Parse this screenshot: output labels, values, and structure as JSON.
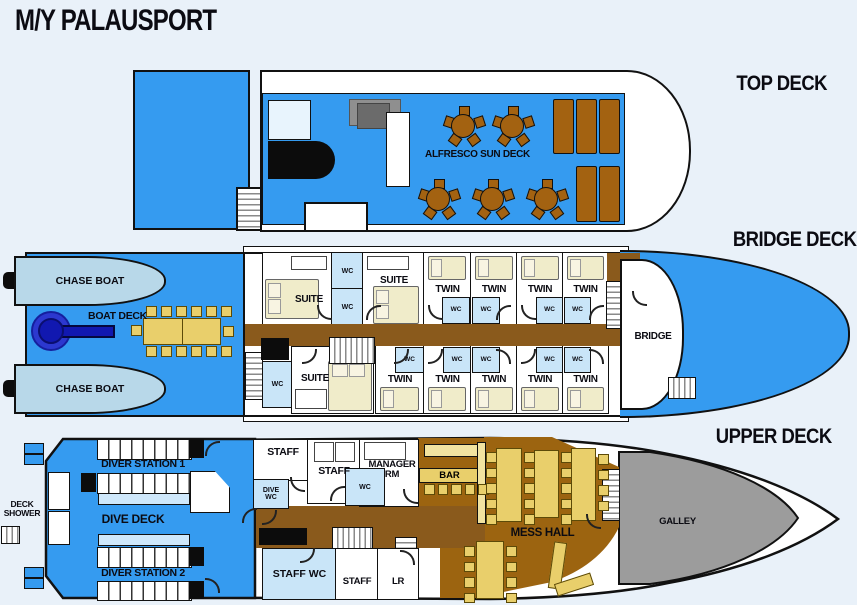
{
  "title": "M/Y PALAUSPORT",
  "deck_labels": {
    "top": "TOP DECK",
    "bridge": "BRIDGE DECK",
    "upper": "UPPER DECK"
  },
  "top_deck": {
    "alfresco_label": "ALFRESCO SUN DECK"
  },
  "bridge_deck": {
    "chase_boat_label": "CHASE BOAT",
    "boat_deck_label": "BOAT DECK",
    "suite_label": "SUITE",
    "twin_label": "TWIN",
    "wc_label": "WC",
    "bridge_label": "BRIDGE"
  },
  "upper_deck": {
    "deck_shower_label": "DECK SHOWER",
    "diver_station_1_label": "DIVER STATION 1",
    "dive_deck_label": "DIVE DECK",
    "diver_station_2_label": "DIVER STATION 2",
    "staff_label": "STAFF",
    "dive_wc_label": "DIVE WC",
    "wc_label": "WC",
    "manager_rm_label": "MANAGER RM",
    "bar_label": "BAR",
    "staff_wc_label": "STAFF WC",
    "lr_label": "LR",
    "mess_hall_label": "MESS HALL",
    "galley_label": "GALLEY"
  },
  "colors": {
    "background": "#e9f1f9",
    "deck_blue": "#359bf0",
    "hull_white": "#ffffff",
    "outline_black": "#111111",
    "corridor_brown": "#8a5a1c",
    "mess_brown": "#9c6410",
    "table_yellow": "#e9cf6b",
    "counter_cream": "#f2e3a0",
    "wood_brown": "#a36211",
    "wc_blue": "#c9e5f8",
    "chase_boat_blue": "#b8d8e9",
    "bed_cream": "#f0ecca",
    "galley_gray": "#9c9c9c",
    "winch_blue": "#1118b0"
  }
}
